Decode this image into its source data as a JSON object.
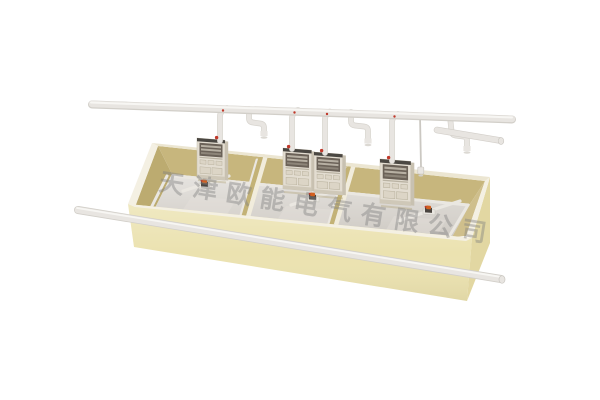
{
  "watermark": {
    "text": "天津欧能电气有限公司"
  },
  "scene": {
    "type": "3d-product-render",
    "subject": "open-top electrical metering enclosure with overhead conduit pipes",
    "compartment_count": 3,
    "meter_cabinet_count": 4,
    "background": "#ffffff"
  },
  "colors": {
    "front_face": "#ebe2b0",
    "outer_right": "#e2d7a2",
    "rim": "#f4f0e3",
    "rim_back": "#ece6d2",
    "wall_back": "#c7b67d",
    "wall_left": "#bcab70",
    "wall_right": "#cfbf8c",
    "partition": "#c3b276",
    "partition_trim": "#f1ecdc",
    "floor": "#d5d1cb",
    "duct": "#eae7e1",
    "pipe": "#e8e5e1",
    "pipe_shadow": "#d2cfc9",
    "pipe_highlight": "#f7f6f3",
    "meter_body": "#e3ddd1",
    "meter_side": "#c8c1b1",
    "meter_cap": "#4a4742",
    "meter_window": "#6b6258",
    "meter_slat": "#b7b0a3",
    "meter_panel": "#dcd5c6",
    "device_dark": "#4a4540",
    "device_orange": "#d2601f",
    "device_red": "#c0392b",
    "watermark_gray": "#808080"
  }
}
